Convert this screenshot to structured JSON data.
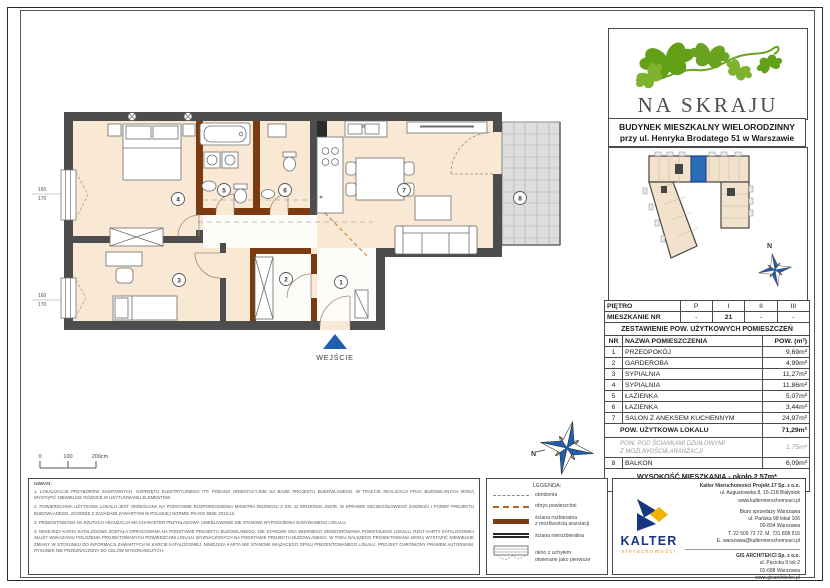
{
  "project": {
    "name": "NA SKRAJU",
    "building_type": "BUDYNEK MIESZKALNY WIELORODZINNY",
    "building_address": "przy ul. Henryka Brodatego 51 w Warszawie"
  },
  "unit_table": {
    "floor_row_label": "PIĘTRO",
    "floor_cols": [
      "P",
      "I",
      "II",
      "III"
    ],
    "unit_row_label": "MIESZKANIE NR",
    "unit_cols": [
      "-",
      "21",
      "-",
      "-"
    ]
  },
  "area_table": {
    "title": "ZESTAWIENIE POW. UŻYTKOWYCH POMIESZCZEŃ",
    "col_nr": "NR",
    "col_name": "NAZWA POMIESZCZENIA",
    "col_area": "POW. (m²)",
    "rooms": [
      {
        "nr": "1",
        "name": "PRZEDPOKÓJ",
        "area": "9,69m²"
      },
      {
        "nr": "2",
        "name": "GARDEROBA",
        "area": "4,99m²"
      },
      {
        "nr": "3",
        "name": "SYPIALNIA",
        "area": "11,27m²"
      },
      {
        "nr": "4",
        "name": "SYPIALNIA",
        "area": "11,86m²"
      },
      {
        "nr": "5",
        "name": "ŁAZIENKA",
        "area": "5,07m²"
      },
      {
        "nr": "6",
        "name": "ŁAZIENKA",
        "area": "3,44m²"
      },
      {
        "nr": "7",
        "name": "SALON Z ANEKSEM KUCHENNYM",
        "area": "24,97m²"
      }
    ],
    "total_label": "POW. UŻYTKOWA LOKALU",
    "total_area": "71,29m²",
    "partition_label_line1": "POW. POD ŚCIANKAMI DZIAŁOWYMI",
    "partition_label_line2": "Z MOŻLIWOŚCIĄ ARANŻACJI",
    "partition_area": "1,75m²",
    "balcony_nr": "8",
    "balcony_label": "BALKON",
    "balcony_area": "6,09m²",
    "height_note": "WYSOKOŚĆ MIESZKANIA - około 2,57m*",
    "height_footnote": "* WYSOKOŚĆ PODANA OD NIEWYKOŃCZONEJ POSADZKI (SZLICHTY) DO OTYNKOWANEGO SUFITU"
  },
  "plan": {
    "entrance_label": "WEJŚCIE",
    "north_label": "N",
    "room_numbers": [
      "1",
      "2",
      "3",
      "4",
      "5",
      "6",
      "7",
      "8"
    ],
    "window_dim_width": "160",
    "window_dim_height": "170",
    "scale_ticks": [
      "0",
      "100",
      "200cm"
    ]
  },
  "legend": {
    "title": "LEGENDA:",
    "item_lowering": "obniżenia",
    "item_outline": "obrys powierzchni",
    "item_removable_1": "ściana rozbieralna",
    "item_removable_2": "z możliwością aranżacji",
    "item_fixed": "ściana nierozbieralna",
    "item_window_1": "okno z uchyłem",
    "item_window_2": "otwierane jako pierwsze"
  },
  "notes": {
    "title": "UWAGI:",
    "items": [
      "1.  LOKALIZACJE PRZYBORÓW SANITARNYCH, OSPRZĘTU ELEKTRYCZNEGO ITP. PODANO ORIENTACYJNIE NA BAZIE PROJEKTU BUDOWLANEGO. W TRAKCIE REALIZACJI PRAC BUDOWLANYCH MOGĄ WYSTĄPIĆ NIEWIELKIE RÓŻNICE W USYTUOWANIU ELEMENTÓW.",
      "2.  POWIERZCHNIA UŻYTKOWA LOKALU JEST OKREŚLONA NA PODSTAWIE ROZPORZĄDZENIA MINISTRA ROZWOJU Z DN. 11 WRZEŚNIA 2020R. W SPRAWIE SZCZEGÓŁOWEGO ZAKRESU I FORMY PROJEKTU BUDOWLANEGO, ZGODNIE Z ZASADAMI ZAWARTYMI W POLSKIEJ NORMIE PN-ISO 9836: 2015-12.",
      "3.  PRZEDSTAWIONA NA RZUTACH ARANŻACJA MA CHARAKTER PRZYKŁADOWY. UMEBLOWANIE NIE STANOWI WYPOSAŻENIA NABYWANEGO LOKALU.",
      "4.  NINIEJSZA KARTA KATALOGOWA ZOSTAŁA OPRACOWANA NA PODSTAWIE PROJEKTU BUDOWLANEGO. NIE STANOWI ONA WIERNEGO ODWZOROWANIA POWSTAŁEGO LOKALU. RZUT KARTY KATALOGOWEJ SŁUŻY WSKAZANIU POŁOŻENIA PROJEKTOWANYCH POWIERZCHNI LOKALU WYZNACZONYCH NA PODSTAWIE PROJEKTU BUDOWLANEGO. W TOKU DALSZEGO PROJEKTOWANIA MOGĄ WYSTĄPIĆ NIEWIELKIE ZMIANY W STOSUNKU DO INFORMACJI ZAWARTYCH W KARCIE KATALOGOWEJ. NINIEJSZA KARTA NIE STANOWI WIĄŻĄCEGO OPISU PREZENTOWANEGO LOKALU. PROJEKT CHRONIONY PRAWEM AUTORSKIM. RYSUNEK NIE PRZEZNACZONY DO CELÓW WYKONAWCZYCH."
    ]
  },
  "kalter": {
    "logo_text": "KALTER",
    "logo_sub": "nieruchomości",
    "company_name": "Kalter Nieruchomości Projekt 17 Sp. z o.o.",
    "company_address": "ul. Augustowska 8, 15-218 Białystok",
    "company_web": "www.kalternieruchomosci.pl",
    "office_name": "Biuro sprzedaży Warszawa",
    "office_address1": "ul. Pańska 98 lokal 106",
    "office_address2": "00-834 Warszawa",
    "office_phone": "T. 22 509 72 72. M. 731 808 516",
    "office_email": "E. warszawa@kalternieruchomosci.pl",
    "architect_name": "GIS ARCHITEKCI Sp. z o.o.",
    "architect_address1": "ul. Pęcicka 9 lok 2",
    "architect_address2": "01-688 Warszawa",
    "architect_web": "www.gisarchitekci.pl"
  },
  "colors": {
    "accent_blue": "#1f5fad",
    "leaf_green": "#6aa31f",
    "kalter_blue": "#16377f",
    "kalter_yellow": "#f0b400",
    "wall_dark": "#4d4d4d",
    "wall_removable": "#7b3a10",
    "room_fill": "#f8e8d4",
    "balcony_fill": "#dedede"
  }
}
